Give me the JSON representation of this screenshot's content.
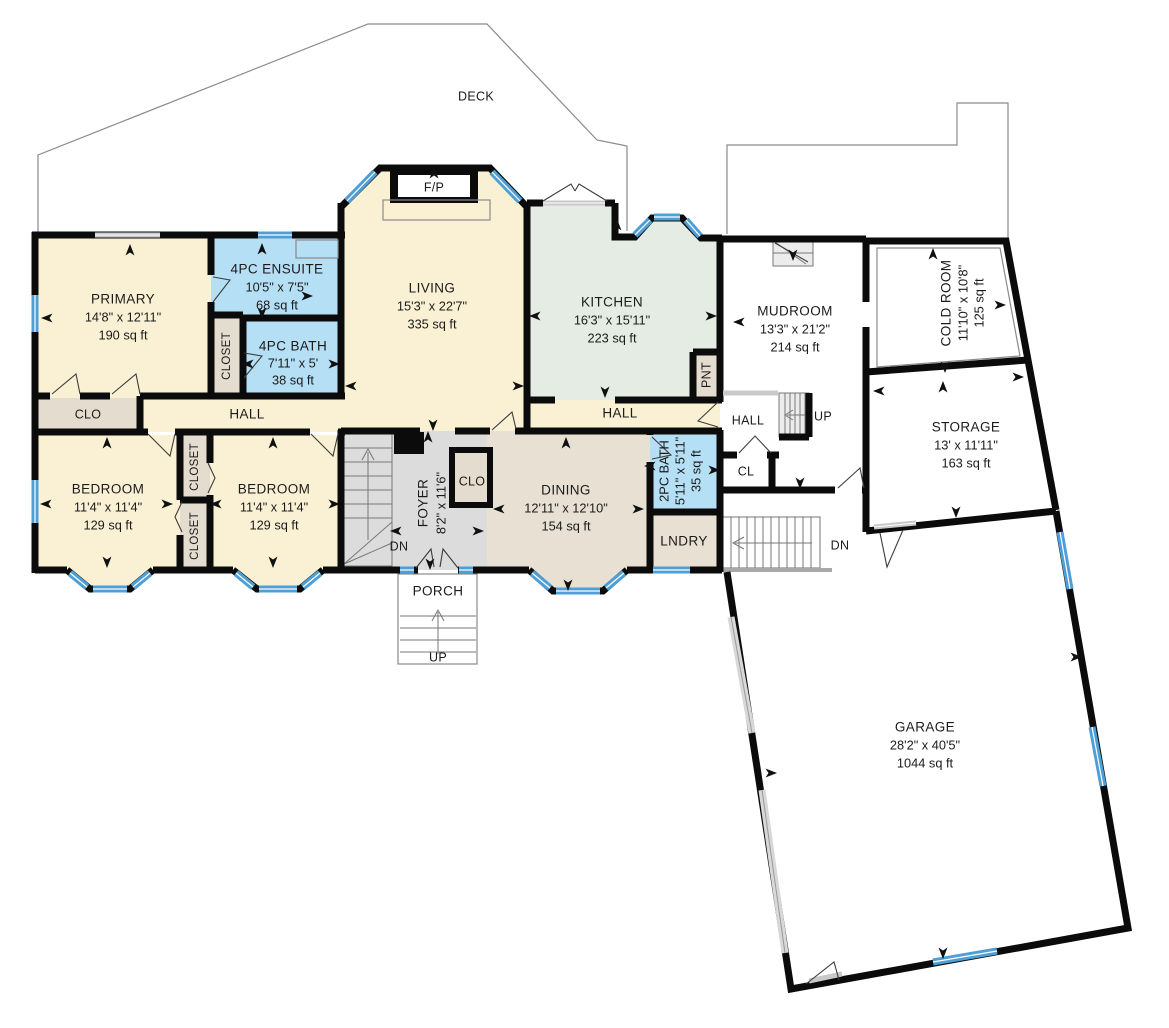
{
  "colors": {
    "wall": "#0b0b0b",
    "window": "#4d9fd6",
    "cream": "#faf1d5",
    "bathblue": "#b5dff4",
    "sage": "#e5ece4",
    "tan": "#e8e0d3",
    "foyergray": "#dcdcdc",
    "closet": "#e4ddcf"
  },
  "deck": {
    "label": "DECK"
  },
  "porch": {
    "label": "PORCH"
  },
  "rooms": {
    "primary": {
      "name": "PRIMARY",
      "dims": "14'8\" x 12'11\"",
      "area": "190 sq ft"
    },
    "ensuite": {
      "name": "4PC ENSUITE",
      "dims": "10'5\" x 7'5\"",
      "area": "68 sq ft"
    },
    "bath4": {
      "name": "4PC BATH",
      "dims": "7'11\" x 5'",
      "area": "38 sq ft"
    },
    "living": {
      "name": "LIVING",
      "dims": "15'3\" x 22'7\"",
      "area": "335 sq ft"
    },
    "kitchen": {
      "name": "KITCHEN",
      "dims": "16'3\" x 15'11\"",
      "area": "223 sq ft"
    },
    "dining": {
      "name": "DINING",
      "dims": "12'11\" x 12'10\"",
      "area": "154 sq ft"
    },
    "bedroom1": {
      "name": "BEDROOM",
      "dims": "11'4\" x 11'4\"",
      "area": "129 sq ft"
    },
    "bedroom2": {
      "name": "BEDROOM",
      "dims": "11'4\" x 11'4\"",
      "area": "129 sq ft"
    },
    "foyer": {
      "name": "FOYER",
      "dims": "8'2\" x 11'6\""
    },
    "bath2": {
      "name": "2PC BATH",
      "dims": "5'11\" x 5'11\"",
      "area": "35 sq ft"
    },
    "lndry": {
      "name": "LNDRY"
    },
    "mudroom": {
      "name": "MUDROOM",
      "dims": "13'3\" x 21'2\"",
      "area": "214 sq ft"
    },
    "coldroom": {
      "name": "COLD ROOM",
      "dims": "11'10\" x 10'8\"",
      "area": "125 sq ft"
    },
    "storage": {
      "name": "STORAGE",
      "dims": "13' x 11'11\"",
      "area": "163 sq ft"
    },
    "garage": {
      "name": "GARAGE",
      "dims": "28'2\" x 40'5\"",
      "area": "1044 sq ft"
    }
  },
  "labels": {
    "hall": "HALL",
    "clo": "CLO",
    "closet": "CLOSET",
    "cl": "CL",
    "pnt": "PNT",
    "fp": "F/P",
    "up": "UP",
    "dn": "DN"
  },
  "arrows": [
    {
      "x": 130,
      "y": 251,
      "r": 0
    },
    {
      "x": 48,
      "y": 318,
      "r": 270
    },
    {
      "x": 262,
      "y": 250,
      "r": 0
    },
    {
      "x": 306,
      "y": 296,
      "r": 90
    },
    {
      "x": 262,
      "y": 312,
      "r": 180
    },
    {
      "x": 249,
      "y": 364,
      "r": 270
    },
    {
      "x": 333,
      "y": 364,
      "r": 90
    },
    {
      "x": 352,
      "y": 386,
      "r": 270
    },
    {
      "x": 517,
      "y": 386,
      "r": 90
    },
    {
      "x": 434,
      "y": 174,
      "r": 0
    },
    {
      "x": 433,
      "y": 424,
      "r": 180
    },
    {
      "x": 536,
      "y": 316,
      "r": 270
    },
    {
      "x": 710,
      "y": 316,
      "r": 90
    },
    {
      "x": 617,
      "y": 226,
      "r": 0
    },
    {
      "x": 605,
      "y": 391,
      "r": 180
    },
    {
      "x": 740,
      "y": 322,
      "r": 270
    },
    {
      "x": 793,
      "y": 254,
      "r": 180
    },
    {
      "x": 800,
      "y": 482,
      "r": 180
    },
    {
      "x": 933,
      "y": 255,
      "r": 0
    },
    {
      "x": 999,
      "y": 305,
      "r": 90
    },
    {
      "x": 945,
      "y": 366,
      "r": 180
    },
    {
      "x": 880,
      "y": 391,
      "r": 270
    },
    {
      "x": 943,
      "y": 388,
      "r": 0
    },
    {
      "x": 1017,
      "y": 377,
      "r": 90
    },
    {
      "x": 956,
      "y": 511,
      "r": 180
    },
    {
      "x": 1075,
      "y": 657,
      "r": 90
    },
    {
      "x": 943,
      "y": 952,
      "r": 180
    },
    {
      "x": 770,
      "y": 773,
      "r": 90
    },
    {
      "x": 107,
      "y": 444,
      "r": 0
    },
    {
      "x": 47,
      "y": 504,
      "r": 270
    },
    {
      "x": 166,
      "y": 504,
      "r": 90
    },
    {
      "x": 107,
      "y": 561,
      "r": 180
    },
    {
      "x": 273,
      "y": 444,
      "r": 0
    },
    {
      "x": 217,
      "y": 504,
      "r": 270
    },
    {
      "x": 333,
      "y": 504,
      "r": 90
    },
    {
      "x": 273,
      "y": 561,
      "r": 180
    },
    {
      "x": 566,
      "y": 444,
      "r": 0
    },
    {
      "x": 500,
      "y": 509,
      "r": 270
    },
    {
      "x": 637,
      "y": 509,
      "r": 90
    },
    {
      "x": 568,
      "y": 584,
      "r": 180
    },
    {
      "x": 397,
      "y": 531,
      "r": 270
    },
    {
      "x": 477,
      "y": 531,
      "r": 90
    },
    {
      "x": 430,
      "y": 563,
      "r": 180
    },
    {
      "x": 428,
      "y": 438,
      "r": 0
    },
    {
      "x": 651,
      "y": 466,
      "r": 270
    },
    {
      "x": 713,
      "y": 470,
      "r": 90
    }
  ]
}
